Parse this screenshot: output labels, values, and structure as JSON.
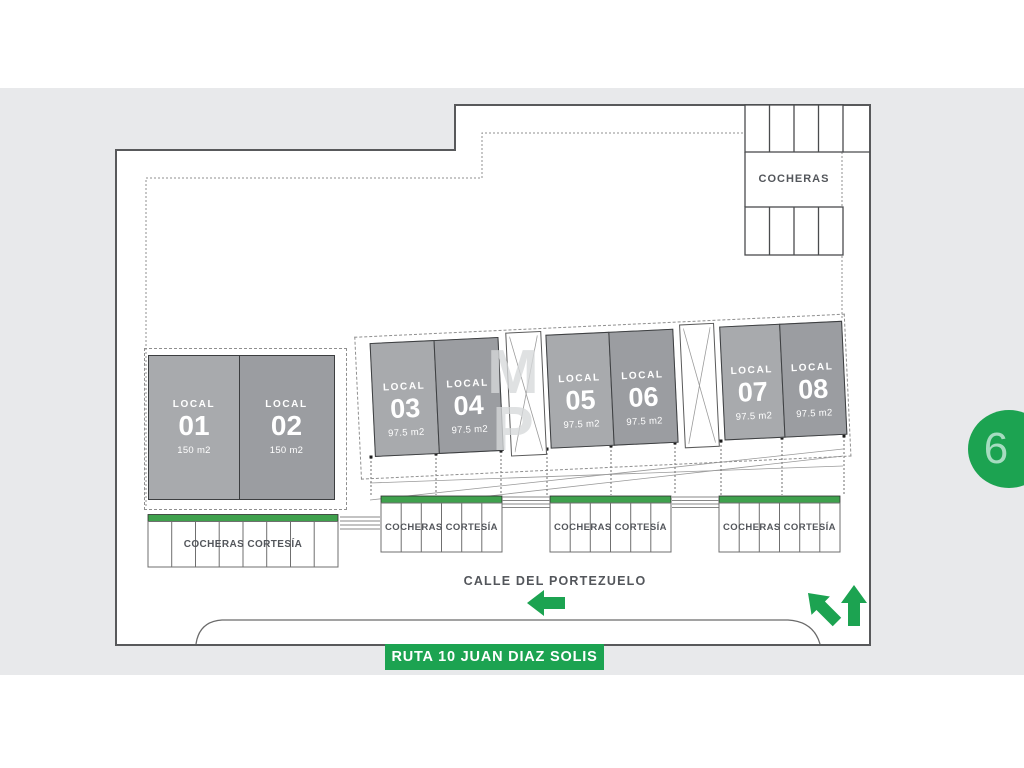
{
  "plan": {
    "cocheras_label": "COCHERAS",
    "locals": [
      {
        "label": "LOCAL",
        "number": "01",
        "area": "150 m2"
      },
      {
        "label": "LOCAL",
        "number": "02",
        "area": "150 m2"
      },
      {
        "label": "LOCAL",
        "number": "03",
        "area": "97.5 m2"
      },
      {
        "label": "LOCAL",
        "number": "04",
        "area": "97.5 m2"
      },
      {
        "label": "LOCAL",
        "number": "05",
        "area": "97.5 m2"
      },
      {
        "label": "LOCAL",
        "number": "06",
        "area": "97.5 m2"
      },
      {
        "label": "LOCAL",
        "number": "07",
        "area": "97.5 m2"
      },
      {
        "label": "LOCAL",
        "number": "08",
        "area": "97.5 m2"
      }
    ],
    "cortesia_labels": [
      "COCHERAS CORTESÍA",
      "COCHERAS CORTESÍA",
      "COCHERAS CORTESÍA",
      "COCHERAS CORTESÍA"
    ],
    "street_name": "CALLE DEL PORTEZUELO",
    "route_banner": "RUTA 10 JUAN DIAZ SOLIS",
    "photo_badge": "6",
    "watermark_top": "M",
    "watermark_bottom": "P",
    "colors": {
      "accent_green": "#1ca351",
      "bar_green": "#3fa14d",
      "panel_bg": "#e8e9eb",
      "local_light": "#a8aaad",
      "local_dark": "#9b9da1"
    }
  }
}
